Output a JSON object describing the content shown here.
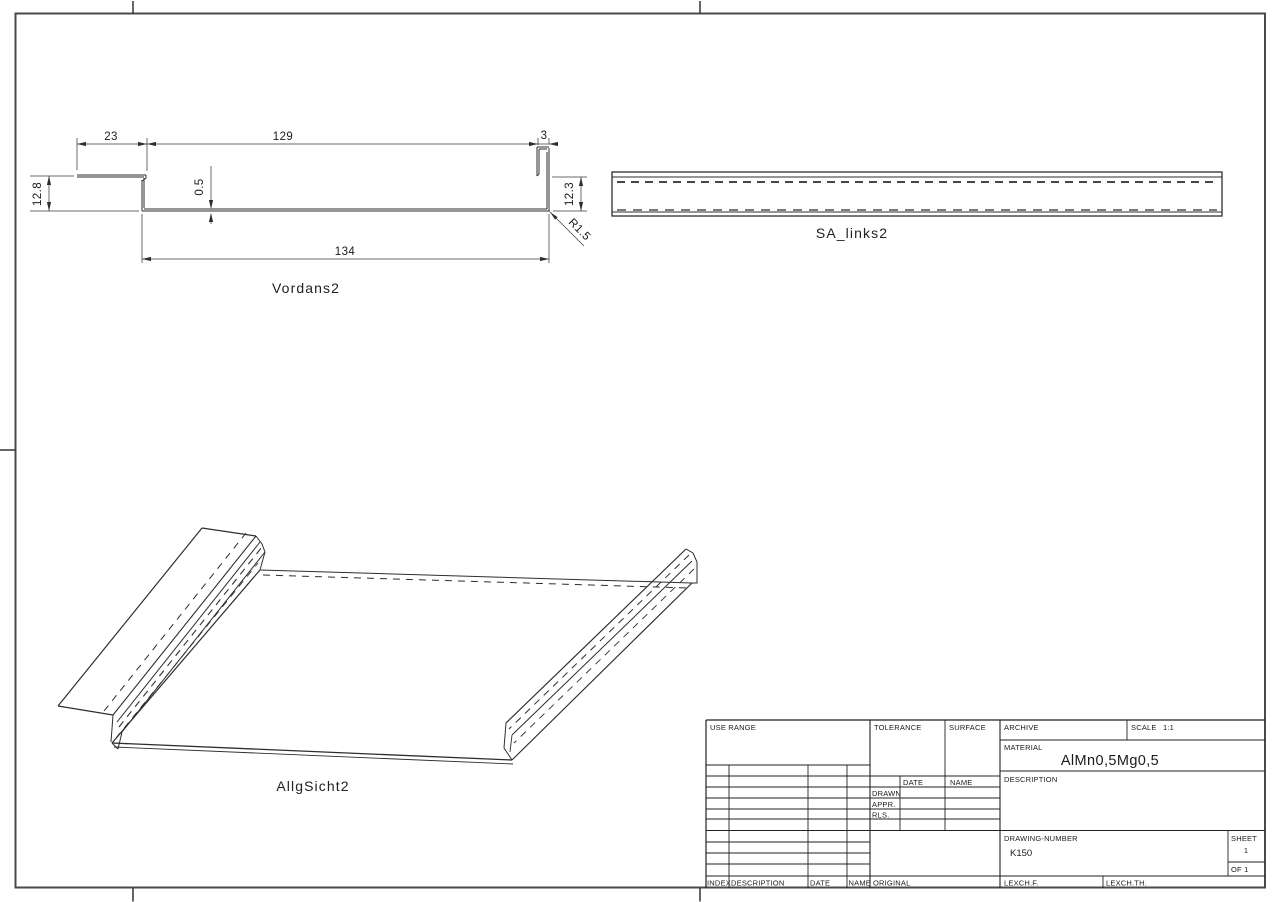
{
  "drawing": {
    "type": "technical-drawing",
    "colors": {
      "line": "#2e2e2e",
      "frame": "#4a4a4a",
      "text": "#1b1b1b",
      "background": "#ffffff"
    },
    "views": {
      "front": {
        "label": "Vordans2",
        "dims": {
          "flange_width": "23",
          "top_span": "129",
          "lip_width": "3",
          "bottom_span": "134",
          "left_height": "12.8",
          "right_height": "12.3",
          "thickness": "0.5",
          "bend_radius": "R1.5"
        }
      },
      "side": {
        "label": "SA_links2"
      },
      "iso": {
        "label": "AllgSicht2"
      }
    },
    "title_block": {
      "use_range": "USE RANGE",
      "tolerance": "TOLERANCE",
      "surface": "SURFACE",
      "archive": "ARCHIVE",
      "scale_label": "SCALE",
      "scale_value": "1:1",
      "material_label": "MATERIAL",
      "material_value": "AlMn0,5Mg0,5",
      "description": "DESCRIPTION",
      "date": "DATE",
      "name": "NAME",
      "drawn": "DRAWN",
      "appr": "APPR.",
      "rls": "RLS.",
      "drawing_number_label": "DRAWING-NUMBER",
      "drawing_number_value": "K150",
      "sheet_label": "SHEET",
      "sheet_value": "1",
      "of_value": "OF 1",
      "index": "INDEX",
      "description_col": "DESCRIPTION",
      "date_col": "DATE",
      "name_col": "NAME",
      "original": "ORIGINAL",
      "lexch_f": "LEXCH.F.",
      "lexch_th": "LEXCH.TH."
    }
  }
}
